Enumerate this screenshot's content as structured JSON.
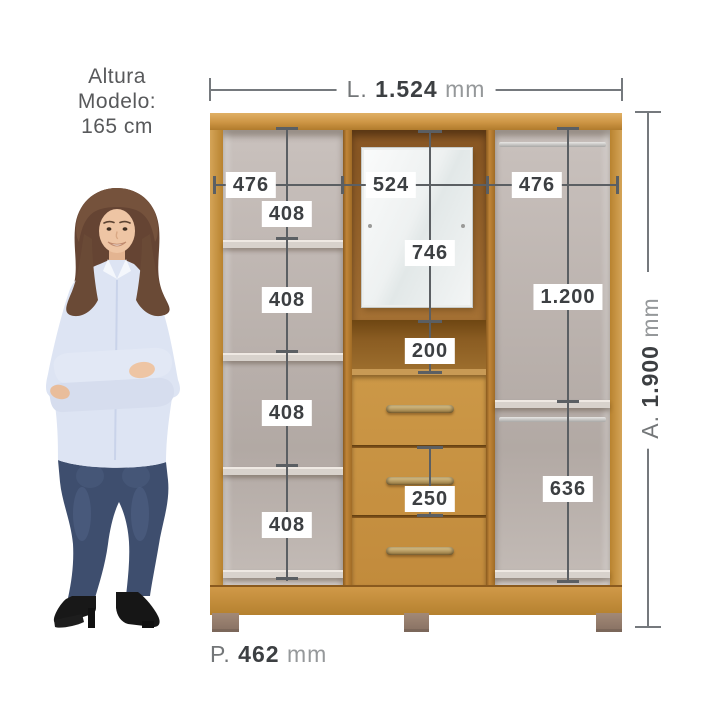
{
  "model_note": {
    "line1": "Altura",
    "line2": "Modelo:",
    "line3": "165 cm"
  },
  "overall_dimensions": {
    "width": {
      "prefix": "L.",
      "value": "1.524",
      "unit": "mm"
    },
    "height": {
      "prefix": "A.",
      "value": "1.900",
      "unit": "mm"
    },
    "depth": {
      "prefix": "P.",
      "value": "462",
      "unit": "mm"
    }
  },
  "internal_dimensions": {
    "left_column_width": "476",
    "center_column_width": "524",
    "right_column_width": "476",
    "left_shelf_gaps": [
      "408",
      "408",
      "408",
      "408"
    ],
    "mirror_section_height": "746",
    "niche_height": "200",
    "middle_drawer_height": "250",
    "right_upper_height": "1.200",
    "right_lower_height": "636"
  },
  "colors": {
    "background": "#ffffff",
    "wood": "#c99040",
    "wood_dark": "#8a5a1e",
    "interior_back": "#bdb4af",
    "dimension_line": "#5b5f63",
    "label_text": "#3c3f42",
    "note_text": "#58595b"
  }
}
